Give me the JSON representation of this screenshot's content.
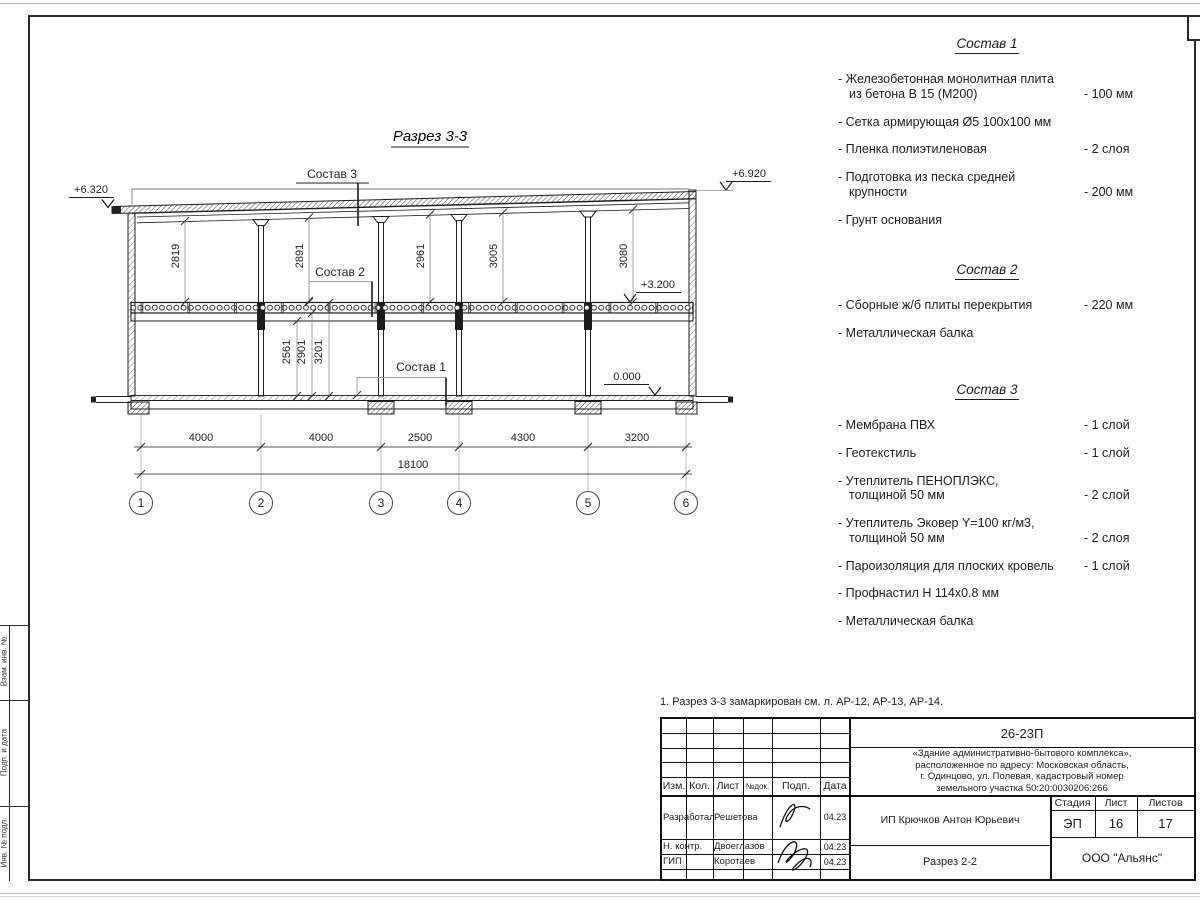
{
  "page": {
    "note": "1. Разрез 3-3 замаркирован см. л. АР-12, АР-13, АР-14."
  },
  "drawing": {
    "title": "Разрез 3-3",
    "labels": {
      "sostav1": "Состав 1",
      "sostav2": "Состав 2",
      "sostav3": "Состав 3"
    },
    "elevations": {
      "top_left": "+6.320",
      "top_right": "+6.920",
      "floor2": "+3.200",
      "ground": "0.000"
    },
    "bay_heights": [
      "2819",
      "2891",
      "2961",
      "3005",
      "3080"
    ],
    "floor1_dims": [
      "2561",
      "2901",
      "3201"
    ],
    "span_dims": [
      "4000",
      "4000",
      "2500",
      "4300",
      "3200"
    ],
    "total_dim": "18100",
    "axes": [
      "1",
      "2",
      "3",
      "4",
      "5",
      "6"
    ]
  },
  "compositions": [
    {
      "title": "Состав 1",
      "items": [
        {
          "name": "- Железобетонная монолитная плита\nиз бетона В 15 (М200)",
          "value": "- 100 мм"
        },
        {
          "name": "- Сетка армирующая Ø5 100х100 мм",
          "value": ""
        },
        {
          "name": "- Пленка полиэтиленовая",
          "value": "- 2 слоя"
        },
        {
          "name": "- Подготовка из песка средней\nкрупности",
          "value": "- 200 мм"
        },
        {
          "name": "- Грунт основания",
          "value": ""
        }
      ]
    },
    {
      "title": "Состав 2",
      "items": [
        {
          "name": "- Сборные ж/б плиты перекрытия",
          "value": "- 220 мм"
        },
        {
          "name": "- Металлическая балка",
          "value": ""
        }
      ]
    },
    {
      "title": "Состав 3",
      "items": [
        {
          "name": "- Мембрана ПВХ",
          "value": "- 1 слой"
        },
        {
          "name": "- Геотекстиль",
          "value": "- 1 слой"
        },
        {
          "name": "- Утеплитель ПЕНОПЛЭКС,\nтолщиной 50 мм",
          "value": "- 2 слой"
        },
        {
          "name": "- Утеплитель Эковер Y=100 кг/м3,\nтолщиной 50 мм",
          "value": "- 2 слоя"
        },
        {
          "name": "- Пароизоляция для плоских кровель",
          "value": "- 1 слой"
        },
        {
          "name": "- Профнастил Н 114х0.8 мм",
          "value": ""
        },
        {
          "name": "- Металлическая балка",
          "value": ""
        }
      ]
    }
  ],
  "titleblock": {
    "doc_number": "26-23П",
    "project": "«Здание административно-бытового комплекса»,\nрасположенное по адресу: Московская область,\nг. Одинцово, ул. Полевая, кадастровый номер\nземельного участка 50:20:0030206:266",
    "cols": {
      "izm": "Изм.",
      "kol": "Кол.",
      "list": "Лист",
      "ndok": "№док.",
      "podp": "Подп.",
      "data": "Дата"
    },
    "rows": [
      {
        "role": "Разработал",
        "name": "Решетова",
        "date": "04.23"
      },
      {
        "role": "Н. контр.",
        "name": "Двоеглазов",
        "date": "04.23"
      },
      {
        "role": "ГИП",
        "name": "Коротаев",
        "date": "04.23"
      }
    ],
    "client": "ИП Крючков Антон Юрьевич",
    "stage_label": "Стадия",
    "sheet_label": "Лист",
    "sheets_label": "Листов",
    "stage": "ЭП",
    "sheet": "16",
    "sheets": "17",
    "sheet_title": "Разрез 2-2",
    "company": "ООО \"Альянс\""
  },
  "side_strip": [
    "Взам. инв. №",
    "Подп. и дата",
    "Инв. № подл."
  ]
}
